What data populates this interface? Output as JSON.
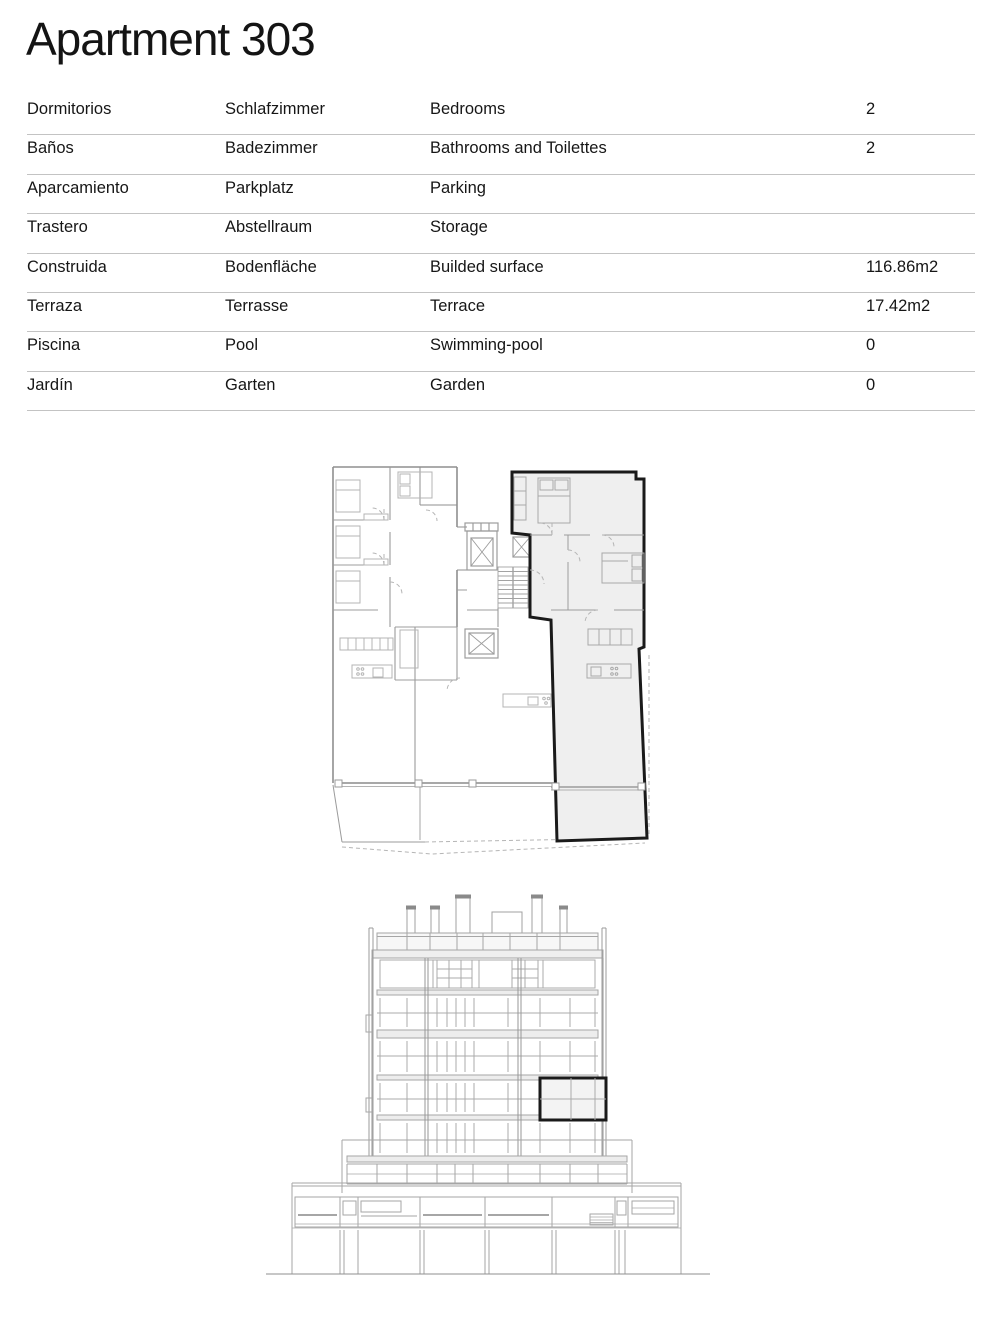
{
  "header": {
    "title": "Apartment 303"
  },
  "spec_table": {
    "rows": [
      {
        "es": "Dormitorios",
        "de": "Schlafzimmer",
        "en": "Bedrooms",
        "value": "2"
      },
      {
        "es": "Baños",
        "de": "Badezimmer",
        "en": "Bathrooms and Toilettes",
        "value": "2"
      },
      {
        "es": "Aparcamiento",
        "de": "Parkplatz",
        "en": "Parking",
        "value": ""
      },
      {
        "es": "Trastero",
        "de": "Abstellraum",
        "en": "Storage",
        "value": ""
      },
      {
        "es": "Construida",
        "de": "Bodenfläche",
        "en": "Builded surface",
        "value": "116.86m2"
      },
      {
        "es": "Terraza",
        "de": "Terrasse",
        "en": "Terrace",
        "value": "17.42m2"
      },
      {
        "es": "Piscina",
        "de": "Pool",
        "en": "Swimming-pool",
        "value": "0"
      },
      {
        "es": "Jardín",
        "de": "Garten",
        "en": "Garden",
        "value": "0"
      }
    ]
  },
  "drawings": {
    "floor_plan": {
      "highlighted_unit": "Apartment 303"
    },
    "elevation": {
      "highlighted_unit": "Apartment 303"
    }
  },
  "colors": {
    "background": "#ffffff",
    "text": "#161616",
    "table_divider": "#c3c3c3",
    "drawing_line": "#9b9b9b",
    "drawing_light_line": "#b5b5b5",
    "highlight_fill": "#efefef",
    "highlight_outline": "#1a1a1a"
  }
}
